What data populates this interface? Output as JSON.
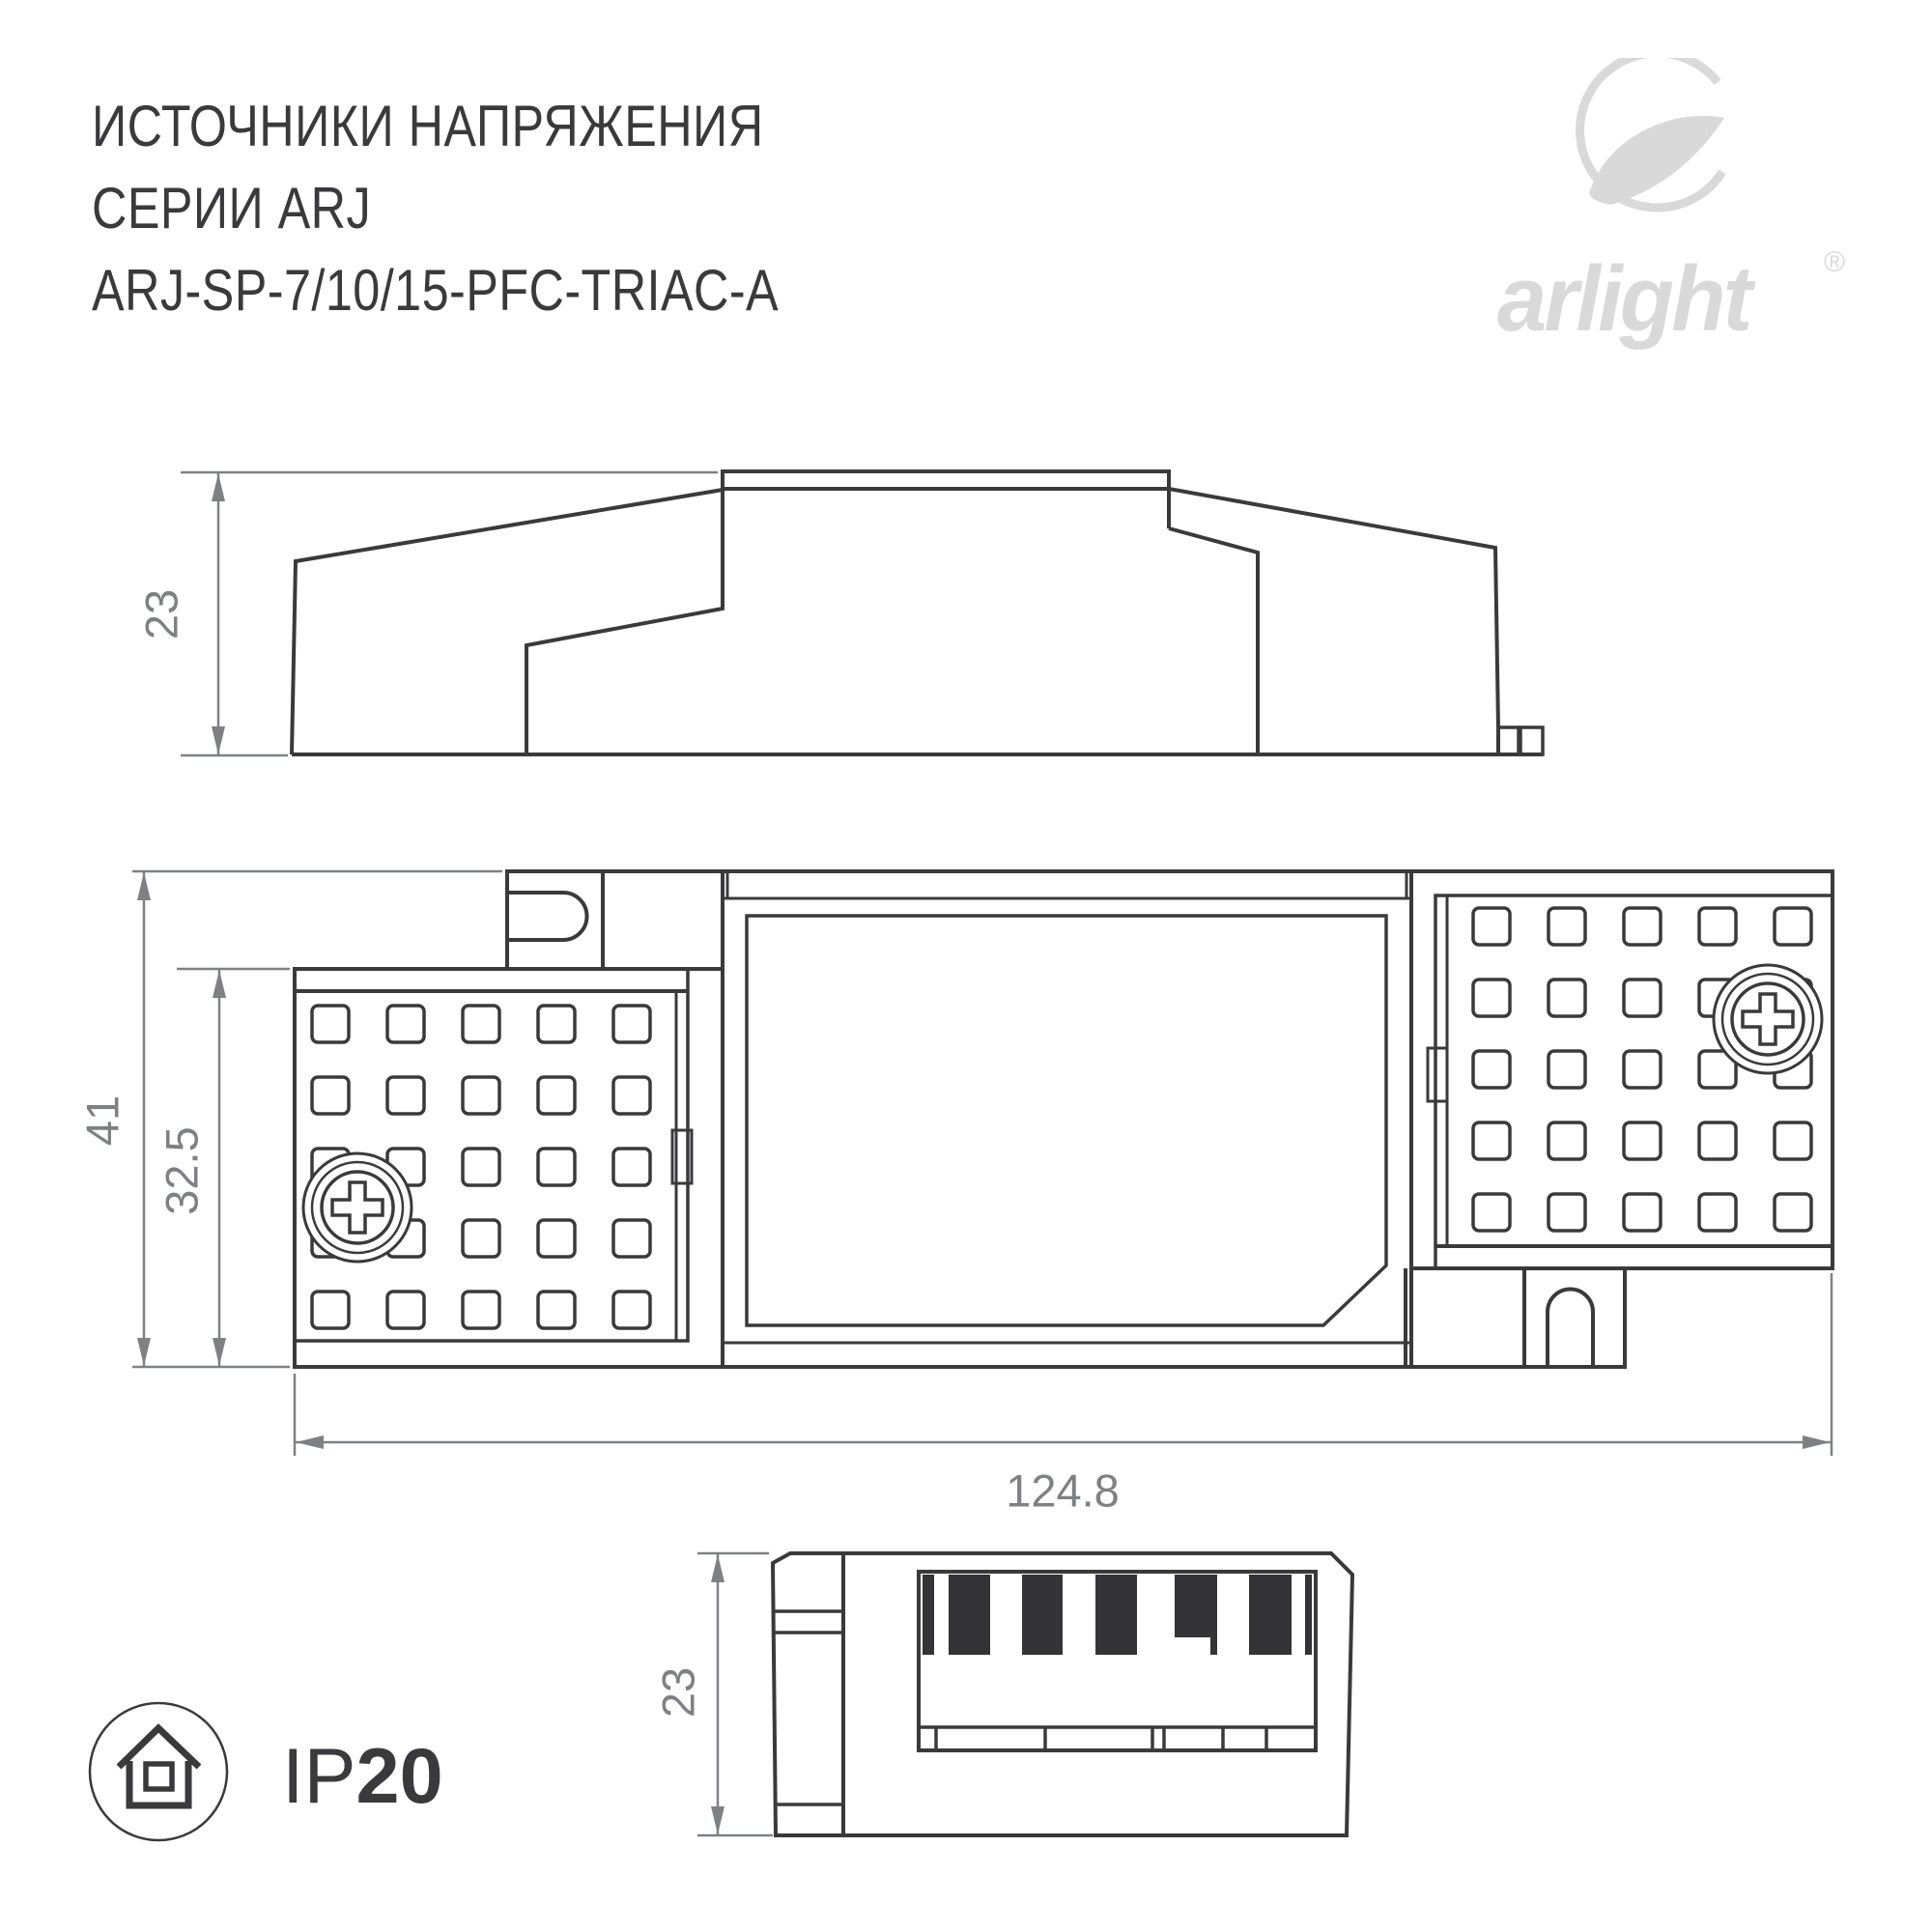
{
  "title": {
    "line1": "ИСТОЧНИКИ НАПРЯЖЕНИЯ",
    "line2": "СЕРИИ ARJ",
    "line3": "ARJ-SP-7/10/15-PFC-TRIAC-A"
  },
  "logo": {
    "brand": "arlight",
    "registered": "®"
  },
  "views": {
    "side": {
      "height_dim": "23"
    },
    "top": {
      "height_dim": "41",
      "inner_height_dim": "32.5",
      "width_dim": "124.8"
    },
    "end": {
      "height_dim": "23"
    }
  },
  "ip_rating": {
    "prefix": "IP",
    "value": "20"
  },
  "colors": {
    "line": "#3a3a3c",
    "dimension": "#7f8083",
    "logo": "#d9d9da",
    "background": "#ffffff"
  }
}
